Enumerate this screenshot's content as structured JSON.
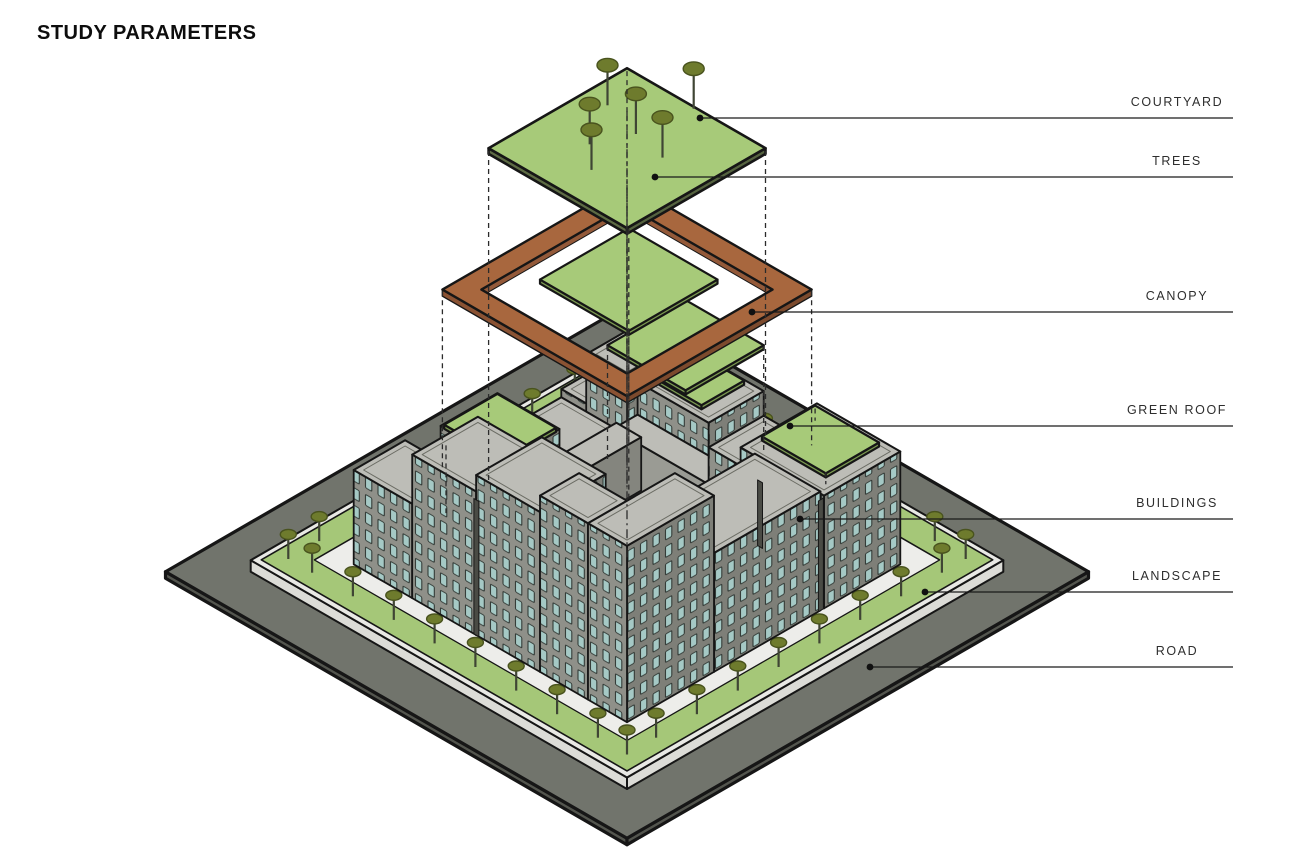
{
  "title": "STUDY PARAMETERS",
  "leader_end_x": 1233,
  "layers": [
    {
      "id": "courtyard",
      "label": "COURTYARD",
      "y": 118,
      "dot": [
        700,
        118
      ]
    },
    {
      "id": "trees",
      "label": "TREES",
      "y": 177,
      "dot": [
        655,
        177
      ]
    },
    {
      "id": "canopy",
      "label": "CANOPY",
      "y": 312,
      "dot": [
        752,
        312
      ]
    },
    {
      "id": "green-roof",
      "label": "GREEN ROOF",
      "y": 426,
      "dot": [
        790,
        426
      ]
    },
    {
      "id": "buildings",
      "label": "BUILDINGS",
      "y": 519,
      "dot": [
        800,
        519
      ]
    },
    {
      "id": "landscape",
      "label": "LANDSCAPE",
      "y": 592,
      "dot": [
        925,
        592
      ]
    },
    {
      "id": "road",
      "label": "ROAD",
      "y": 667,
      "dot": [
        870,
        667
      ]
    }
  ],
  "palette": {
    "outline": "#161616",
    "road": "#71746c",
    "road_side": "#53554e",
    "plinth": "#e9e9e5",
    "plinth_side": "#dcdcd7",
    "grass": "#a5c778",
    "sidewalk": "#ededea",
    "floor": "#f0f0ec",
    "roof": "#bdbdb7",
    "parapet": "#6b6c64",
    "wall_left": "#8f9089",
    "wall_right": "#7e7f78",
    "inner_left": "#9a9b94",
    "inner_right": "#84857e",
    "slot": "#4a4b45",
    "window": "#a5c9c5",
    "window_frame": "#2f3733",
    "green": "#a7ca79",
    "green_side": "#7a9850",
    "canopy_top": "#a8673e",
    "canopy_left": "#8a5233",
    "canopy_right": "#7c4a2d",
    "canopy_inner": "#935939",
    "tree": "#6e7b2d",
    "tree_edge": "#49531e",
    "stem": "#3f4534",
    "leader": "#1a1a1a",
    "dash": "#2b2b2b",
    "label": "#2e2e2e"
  },
  "scene": {
    "iso": {
      "cx": 627,
      "cy": 306,
      "ux": 35.5,
      "uy": 20.5,
      "uz": 41
    },
    "road": {
      "r": [
        0,
        0,
        13,
        13
      ],
      "z": 0.02,
      "t": 0.16
    },
    "plinth": {
      "r": [
        1.2,
        1.2,
        11.8,
        11.8
      ],
      "z": 0.3,
      "t": 0.28
    },
    "landscape": {
      "outer": [
        1.35,
        1.35,
        11.65,
        11.65
      ],
      "inner": [
        2.1,
        2.1,
        10.9,
        10.9
      ],
      "z": 0.31
    },
    "sidewalk": {
      "outer": [
        2.1,
        2.1,
        10.9,
        10.9
      ],
      "inner": [
        2.75,
        2.75,
        10.45,
        10.45
      ],
      "z": 0.305
    },
    "courtyard_floor": {
      "r": [
        4.3,
        4.3,
        8.6,
        8.6
      ],
      "z": 0.3
    },
    "boxes": [
      {
        "b": [
          2.75,
          2.75,
          4.6,
          4.6
        ],
        "h": 1.35,
        "w": 1
      },
      {
        "b": [
          2.85,
          2.85,
          4.0,
          4.0
        ],
        "h": 1.95,
        "w": 1
      },
      {
        "b": [
          4.6,
          2.75,
          6.6,
          4.3
        ],
        "h": 2.3,
        "w": 1,
        "g": [
          4.7,
          2.8,
          6.1,
          4.0
        ]
      },
      {
        "b": [
          2.75,
          4.6,
          4.3,
          6.4
        ],
        "h": 1.15,
        "w": 1
      },
      {
        "b": [
          4.6,
          4.3,
          8.1,
          5.0
        ],
        "h": 1.5,
        "w": 2
      },
      {
        "b": [
          4.3,
          4.6,
          5.0,
          8.0
        ],
        "h": 1.3,
        "w": 2
      },
      {
        "b": [
          2.75,
          6.4,
          4.5,
          8.0
        ],
        "h": 2.15,
        "w": 1,
        "g": [
          2.8,
          6.45,
          4.45,
          7.95
        ]
      },
      {
        "b": [
          6.6,
          2.75,
          8.1,
          4.3
        ],
        "h": 1.7,
        "w": 1
      },
      {
        "b": [
          2.75,
          8.0,
          3.9,
          9.0
        ],
        "h": 1.45,
        "w": 1,
        "g": [
          2.8,
          8.05,
          3.85,
          8.95
        ]
      },
      {
        "b": [
          8.1,
          2.75,
          10.45,
          4.9
        ],
        "h": 2.75,
        "w": 1
      },
      {
        "b": [
          2.75,
          9.0,
          4.4,
          10.45
        ],
        "h": 2.3,
        "w": 1
      },
      {
        "b": [
          8.0,
          5.0,
          8.6,
          8.6
        ],
        "h": 2.2,
        "w": 2
      },
      {
        "b": [
          5.0,
          8.0,
          8.0,
          8.6
        ],
        "h": 2.6,
        "w": 2
      },
      {
        "b": [
          4.4,
          8.6,
          6.2,
          10.45
        ],
        "h": 3.5,
        "w": 1
      },
      {
        "b": [
          8.6,
          5.0,
          10.45,
          8.0
        ],
        "h": 2.9,
        "w": 1
      },
      {
        "b": [
          6.2,
          8.6,
          8.0,
          10.45
        ],
        "h": 3.9,
        "w": 1
      },
      {
        "b": [
          8.0,
          8.0,
          9.35,
          9.35
        ],
        "h": 2.9,
        "w": 1
      },
      {
        "b": [
          8.0,
          9.35,
          9.35,
          10.45
        ],
        "h": 4.3,
        "w": 1
      },
      {
        "b": [
          9.35,
          8.0,
          10.45,
          10.45
        ],
        "h": 4.3,
        "w": 1
      }
    ],
    "slots": [
      [
        "y",
        6.14,
        6.28,
        10.452,
        3.3
      ],
      [
        "y",
        7.98,
        8.12,
        4.302,
        1.6
      ],
      [
        "x",
        4.92,
        5.06,
        10.452,
        2.7
      ]
    ],
    "floating_greens": [
      {
        "r": [
          8.2,
          2.9,
          10.0,
          4.4
        ],
        "z": 3.12
      },
      {
        "r": [
          6.5,
          4.85,
          8.7,
          7.05
        ],
        "z": 5.82
      },
      {
        "r": [
          5.25,
          5.2,
          7.75,
          7.7
        ],
        "z": 7.12
      }
    ],
    "canopy": {
      "outer": [
        3.9,
        3.9,
        9.1,
        9.1
      ],
      "inner": [
        4.45,
        4.45,
        8.55,
        8.55
      ],
      "z": 6.9,
      "t": 0.16
    },
    "courtyard": {
      "r": [
        4.55,
        4.55,
        8.45,
        8.45
      ],
      "z": 10.35,
      "t": 0.14
    },
    "courtyard_trees": [
      [
        6.5,
        4.62
      ],
      [
        5.2,
        5.75
      ],
      [
        6.3,
        6.05
      ],
      [
        5.9,
        6.95
      ],
      [
        7.25,
        6.25
      ],
      [
        6.55,
        7.55
      ]
    ],
    "ring_trees": [
      [
        2.4,
        11.27
      ],
      [
        3.55,
        11.27
      ],
      [
        4.7,
        11.27
      ],
      [
        5.85,
        11.27
      ],
      [
        7.0,
        11.27
      ],
      [
        8.15,
        11.27
      ],
      [
        9.3,
        11.27
      ],
      [
        10.45,
        11.27
      ],
      [
        11.27,
        2.4
      ],
      [
        11.27,
        3.55
      ],
      [
        11.27,
        4.7
      ],
      [
        11.27,
        5.85
      ],
      [
        11.27,
        7.0
      ],
      [
        11.27,
        8.15
      ],
      [
        11.27,
        9.3
      ],
      [
        11.27,
        10.45
      ],
      [
        1.73,
        3.2
      ],
      [
        1.73,
        4.4
      ],
      [
        1.73,
        5.6
      ],
      [
        1.73,
        6.8
      ],
      [
        1.73,
        8.0
      ],
      [
        1.73,
        9.2
      ],
      [
        1.73,
        10.4
      ],
      [
        3.2,
        1.73
      ],
      [
        4.4,
        1.73
      ],
      [
        5.6,
        1.73
      ],
      [
        6.8,
        1.73
      ],
      [
        8.0,
        1.73
      ],
      [
        9.2,
        1.73
      ],
      [
        10.4,
        1.73
      ],
      [
        11.27,
        11.27
      ],
      [
        1.73,
        11.27
      ],
      [
        11.27,
        1.73
      ]
    ],
    "dashed": [
      [
        6.5,
        6.5,
        11.25,
        0.35,
        "dd"
      ],
      [
        4.55,
        4.55,
        10.28,
        2.32,
        "d"
      ],
      [
        8.45,
        4.55,
        10.28,
        3.3,
        "d"
      ],
      [
        8.45,
        8.45,
        10.28,
        4.65,
        "d"
      ],
      [
        4.55,
        8.45,
        10.28,
        2.2,
        "d"
      ],
      [
        3.9,
        3.9,
        6.86,
        2.0,
        "d"
      ],
      [
        9.1,
        3.9,
        6.86,
        3.1,
        "d"
      ],
      [
        3.9,
        9.1,
        6.86,
        2.5,
        "d"
      ],
      [
        9.1,
        9.1,
        6.86,
        4.65,
        "d"
      ],
      [
        5.25,
        5.2,
        7.1,
        1.85,
        "d"
      ],
      [
        7.75,
        7.7,
        7.1,
        2.95,
        "d"
      ],
      [
        8.7,
        4.85,
        5.8,
        3.2,
        "d"
      ],
      [
        6.5,
        7.05,
        5.8,
        2.95,
        "d"
      ],
      [
        8.25,
        2.95,
        3.1,
        2.8,
        "d"
      ],
      [
        9.95,
        4.35,
        3.1,
        2.8,
        "d"
      ],
      [
        3.4,
        8.5,
        2.55,
        0.9,
        "d"
      ]
    ]
  }
}
